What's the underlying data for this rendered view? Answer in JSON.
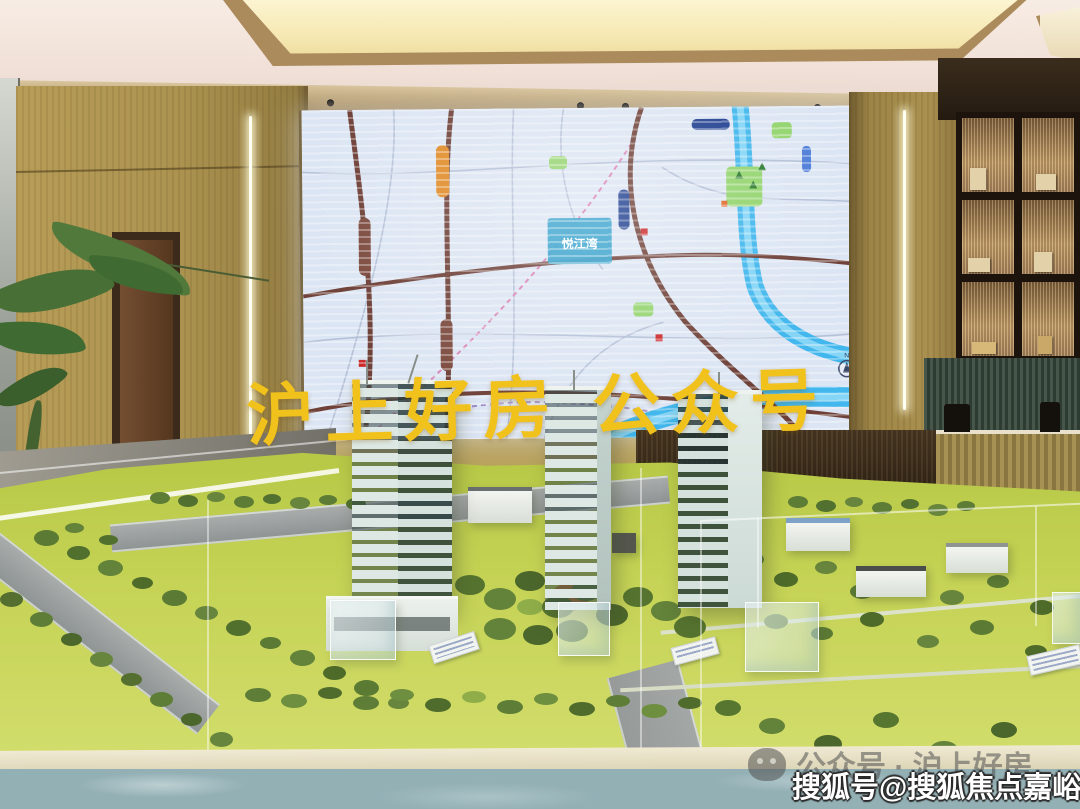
{
  "watermarks": {
    "overlay_main": "沪上好房 公众号",
    "wechat_label": "公众号 · 沪上好房",
    "sohu_label": "搜狐号@搜狐焦点嘉峪关站"
  },
  "map_screen": {
    "project_label": "悦江湾",
    "compass_label": "N"
  },
  "icons": {
    "wechat": "wechat-icon",
    "security_camera": "security-camera-icon",
    "compass": "compass-icon",
    "downlight": "downlight-icon"
  },
  "colors": {
    "watermark_yellow": "#f1c11c",
    "map_water_blue": "#41b7ed",
    "map_road_brown": "#6f4138",
    "map_park_green": "#93d46e",
    "map_background": "#dce5f3",
    "metro_orange": "#e08a26",
    "metro_navy": "#1f3f8f",
    "wall_wood_gold": "#ad9550",
    "model_lawn_green": "#c2d24e",
    "base_marble_teal": "#95b2b6"
  }
}
